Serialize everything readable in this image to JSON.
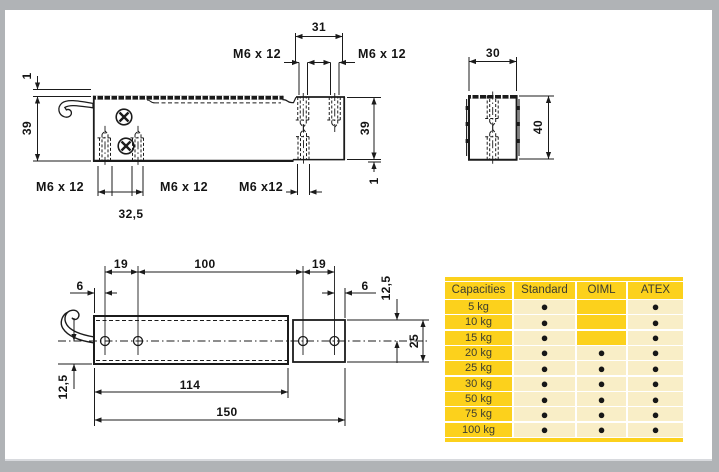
{
  "colors": {
    "gold": "#fcd11c",
    "cream": "#f9eec7",
    "frame": "#b0b3b6",
    "ink": "#1b1b1b"
  },
  "side_view": {
    "dim_31": "31",
    "m6_top_left": "M6 x 12",
    "m6_top_right": "M6 x 12",
    "dim_1_left": "1",
    "dim_39_left": "39",
    "dim_39_right": "39",
    "dim_1_right": "1",
    "m6_bottom_left": "M6 x 12",
    "m6_bottom_mid": "M6 x 12",
    "m6_bottom_right": "M6 x12",
    "dim_32_5": "32,5"
  },
  "end_view": {
    "dim_30": "30",
    "dim_40": "40"
  },
  "top_view": {
    "dim_19_left": "19",
    "dim_100": "100",
    "dim_19_right": "19",
    "dim_6_left": "6",
    "dim_6_right": "6",
    "dim_12_5_right": "12,5",
    "dim_25": "25",
    "dim_12_5_left": "12,5",
    "dim_114": "114",
    "dim_150": "150"
  },
  "table": {
    "headers": [
      "Capacities",
      "Standard",
      "OIML",
      "ATEX"
    ],
    "rows": [
      {
        "capacity": "5 kg",
        "standard": "●",
        "oiml": "",
        "atex": "●"
      },
      {
        "capacity": "10 kg",
        "standard": "●",
        "oiml": "",
        "atex": "●"
      },
      {
        "capacity": "15 kg",
        "standard": "●",
        "oiml": "",
        "atex": "●"
      },
      {
        "capacity": "20 kg",
        "standard": "●",
        "oiml": "●",
        "atex": "●"
      },
      {
        "capacity": "25 kg",
        "standard": "●",
        "oiml": "●",
        "atex": "●"
      },
      {
        "capacity": "30 kg",
        "standard": "●",
        "oiml": "●",
        "atex": "●"
      },
      {
        "capacity": "50 kg",
        "standard": "●",
        "oiml": "●",
        "atex": "●"
      },
      {
        "capacity": "75 kg",
        "standard": "●",
        "oiml": "●",
        "atex": "●"
      },
      {
        "capacity": "100 kg",
        "standard": "●",
        "oiml": "●",
        "atex": "●"
      }
    ]
  }
}
